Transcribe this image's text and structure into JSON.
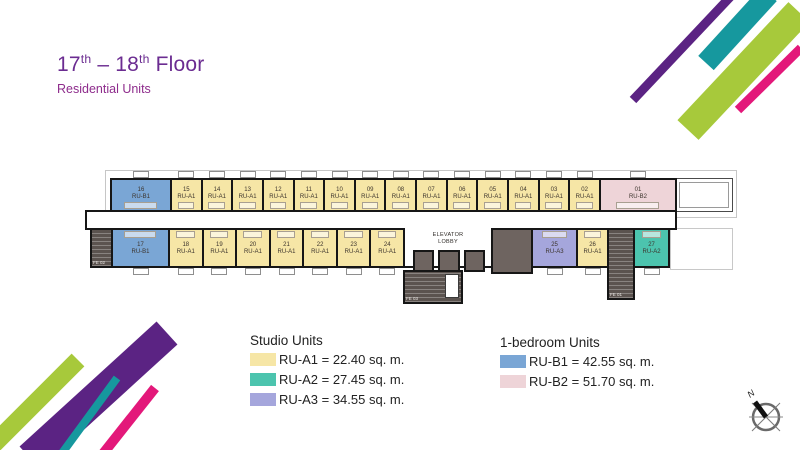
{
  "title": {
    "n1": "17",
    "s1": "th",
    "mid": " – 18",
    "s2": "th",
    "rest": " Floor",
    "subtitle": "Residential Units"
  },
  "colors": {
    "ru_a1": "#f6e6a6",
    "ru_a2": "#4cc4ae",
    "ru_a3": "#a5a6dc",
    "ru_b1": "#7aa6d5",
    "ru_b2": "#eed4d8",
    "wall": "#161616",
    "stair_gray": "#5b534f",
    "elevator_gray": "#6e6460",
    "title_purple": "#6b2c91",
    "subtitle_magenta": "#8e2c8c",
    "accent_purple": "#5b2383",
    "accent_teal": "#16989e",
    "accent_lime": "#a7c93b",
    "accent_magenta": "#e3187a"
  },
  "plan": {
    "lobby": {
      "line1": "ELEVATOR",
      "line2": "LOBBY"
    },
    "fe03_label": "FE 03",
    "top_units": [
      {
        "num": "16",
        "type": "RU-B1",
        "w": 62
      },
      {
        "num": "15",
        "type": "RU-A1"
      },
      {
        "num": "14",
        "type": "RU-A1"
      },
      {
        "num": "13",
        "type": "RU-A1"
      },
      {
        "num": "12",
        "type": "RU-A1"
      },
      {
        "num": "11",
        "type": "RU-A1"
      },
      {
        "num": "10",
        "type": "RU-A1"
      },
      {
        "num": "09",
        "type": "RU-A1"
      },
      {
        "num": "08",
        "type": "RU-A1"
      },
      {
        "num": "07",
        "type": "RU-A1"
      },
      {
        "num": "06",
        "type": "RU-A1"
      },
      {
        "num": "05",
        "type": "RU-A1"
      },
      {
        "num": "04",
        "type": "RU-A1"
      },
      {
        "num": "03",
        "type": "RU-A1"
      },
      {
        "num": "02",
        "type": "RU-A1"
      },
      {
        "num": "01",
        "type": "RU-B2",
        "w": 78
      }
    ],
    "bottom_row": [
      {
        "kind": "stair",
        "label": "FE 02",
        "name": "fire-exit-02",
        "w": 23
      },
      {
        "kind": "unit",
        "num": "17",
        "type": "RU-B1",
        "w": 59
      },
      {
        "kind": "unit",
        "num": "18",
        "type": "RU-A1"
      },
      {
        "kind": "unit",
        "num": "19",
        "type": "RU-A1"
      },
      {
        "kind": "unit",
        "num": "20",
        "type": "RU-A1"
      },
      {
        "kind": "unit",
        "num": "21",
        "type": "RU-A1"
      },
      {
        "kind": "unit",
        "num": "22",
        "type": "RU-A1"
      },
      {
        "kind": "unit",
        "num": "23",
        "type": "RU-A1"
      },
      {
        "kind": "unit",
        "num": "24",
        "type": "RU-A1"
      },
      {
        "kind": "lobby",
        "w": 90
      },
      {
        "kind": "service",
        "w": 42
      },
      {
        "kind": "unit",
        "num": "25",
        "type": "RU-A3",
        "w": 47
      },
      {
        "kind": "unit",
        "num": "26",
        "type": "RU-A1",
        "w": 33
      },
      {
        "kind": "stair",
        "label": "FE 01",
        "name": "fire-exit-01",
        "tall": true,
        "w": 28
      },
      {
        "kind": "unit",
        "num": "27",
        "type": "RU-A2",
        "w": 37
      }
    ]
  },
  "legend": {
    "studio": {
      "title": "Studio Units",
      "items": [
        {
          "key": "ru_a1",
          "text": "RU-A1 = 22.40 sq. m."
        },
        {
          "key": "ru_a2",
          "text": "RU-A2 = 27.45 sq. m."
        },
        {
          "key": "ru_a3",
          "text": "RU-A3 = 34.55 sq. m."
        }
      ]
    },
    "one_bedroom": {
      "title": "1-bedroom Units",
      "items": [
        {
          "key": "ru_b1",
          "text": "RU-B1 = 42.55 sq. m."
        },
        {
          "key": "ru_b2",
          "text": "RU-B2 = 51.70 sq. m."
        }
      ]
    }
  },
  "compass": {
    "label": "N"
  }
}
